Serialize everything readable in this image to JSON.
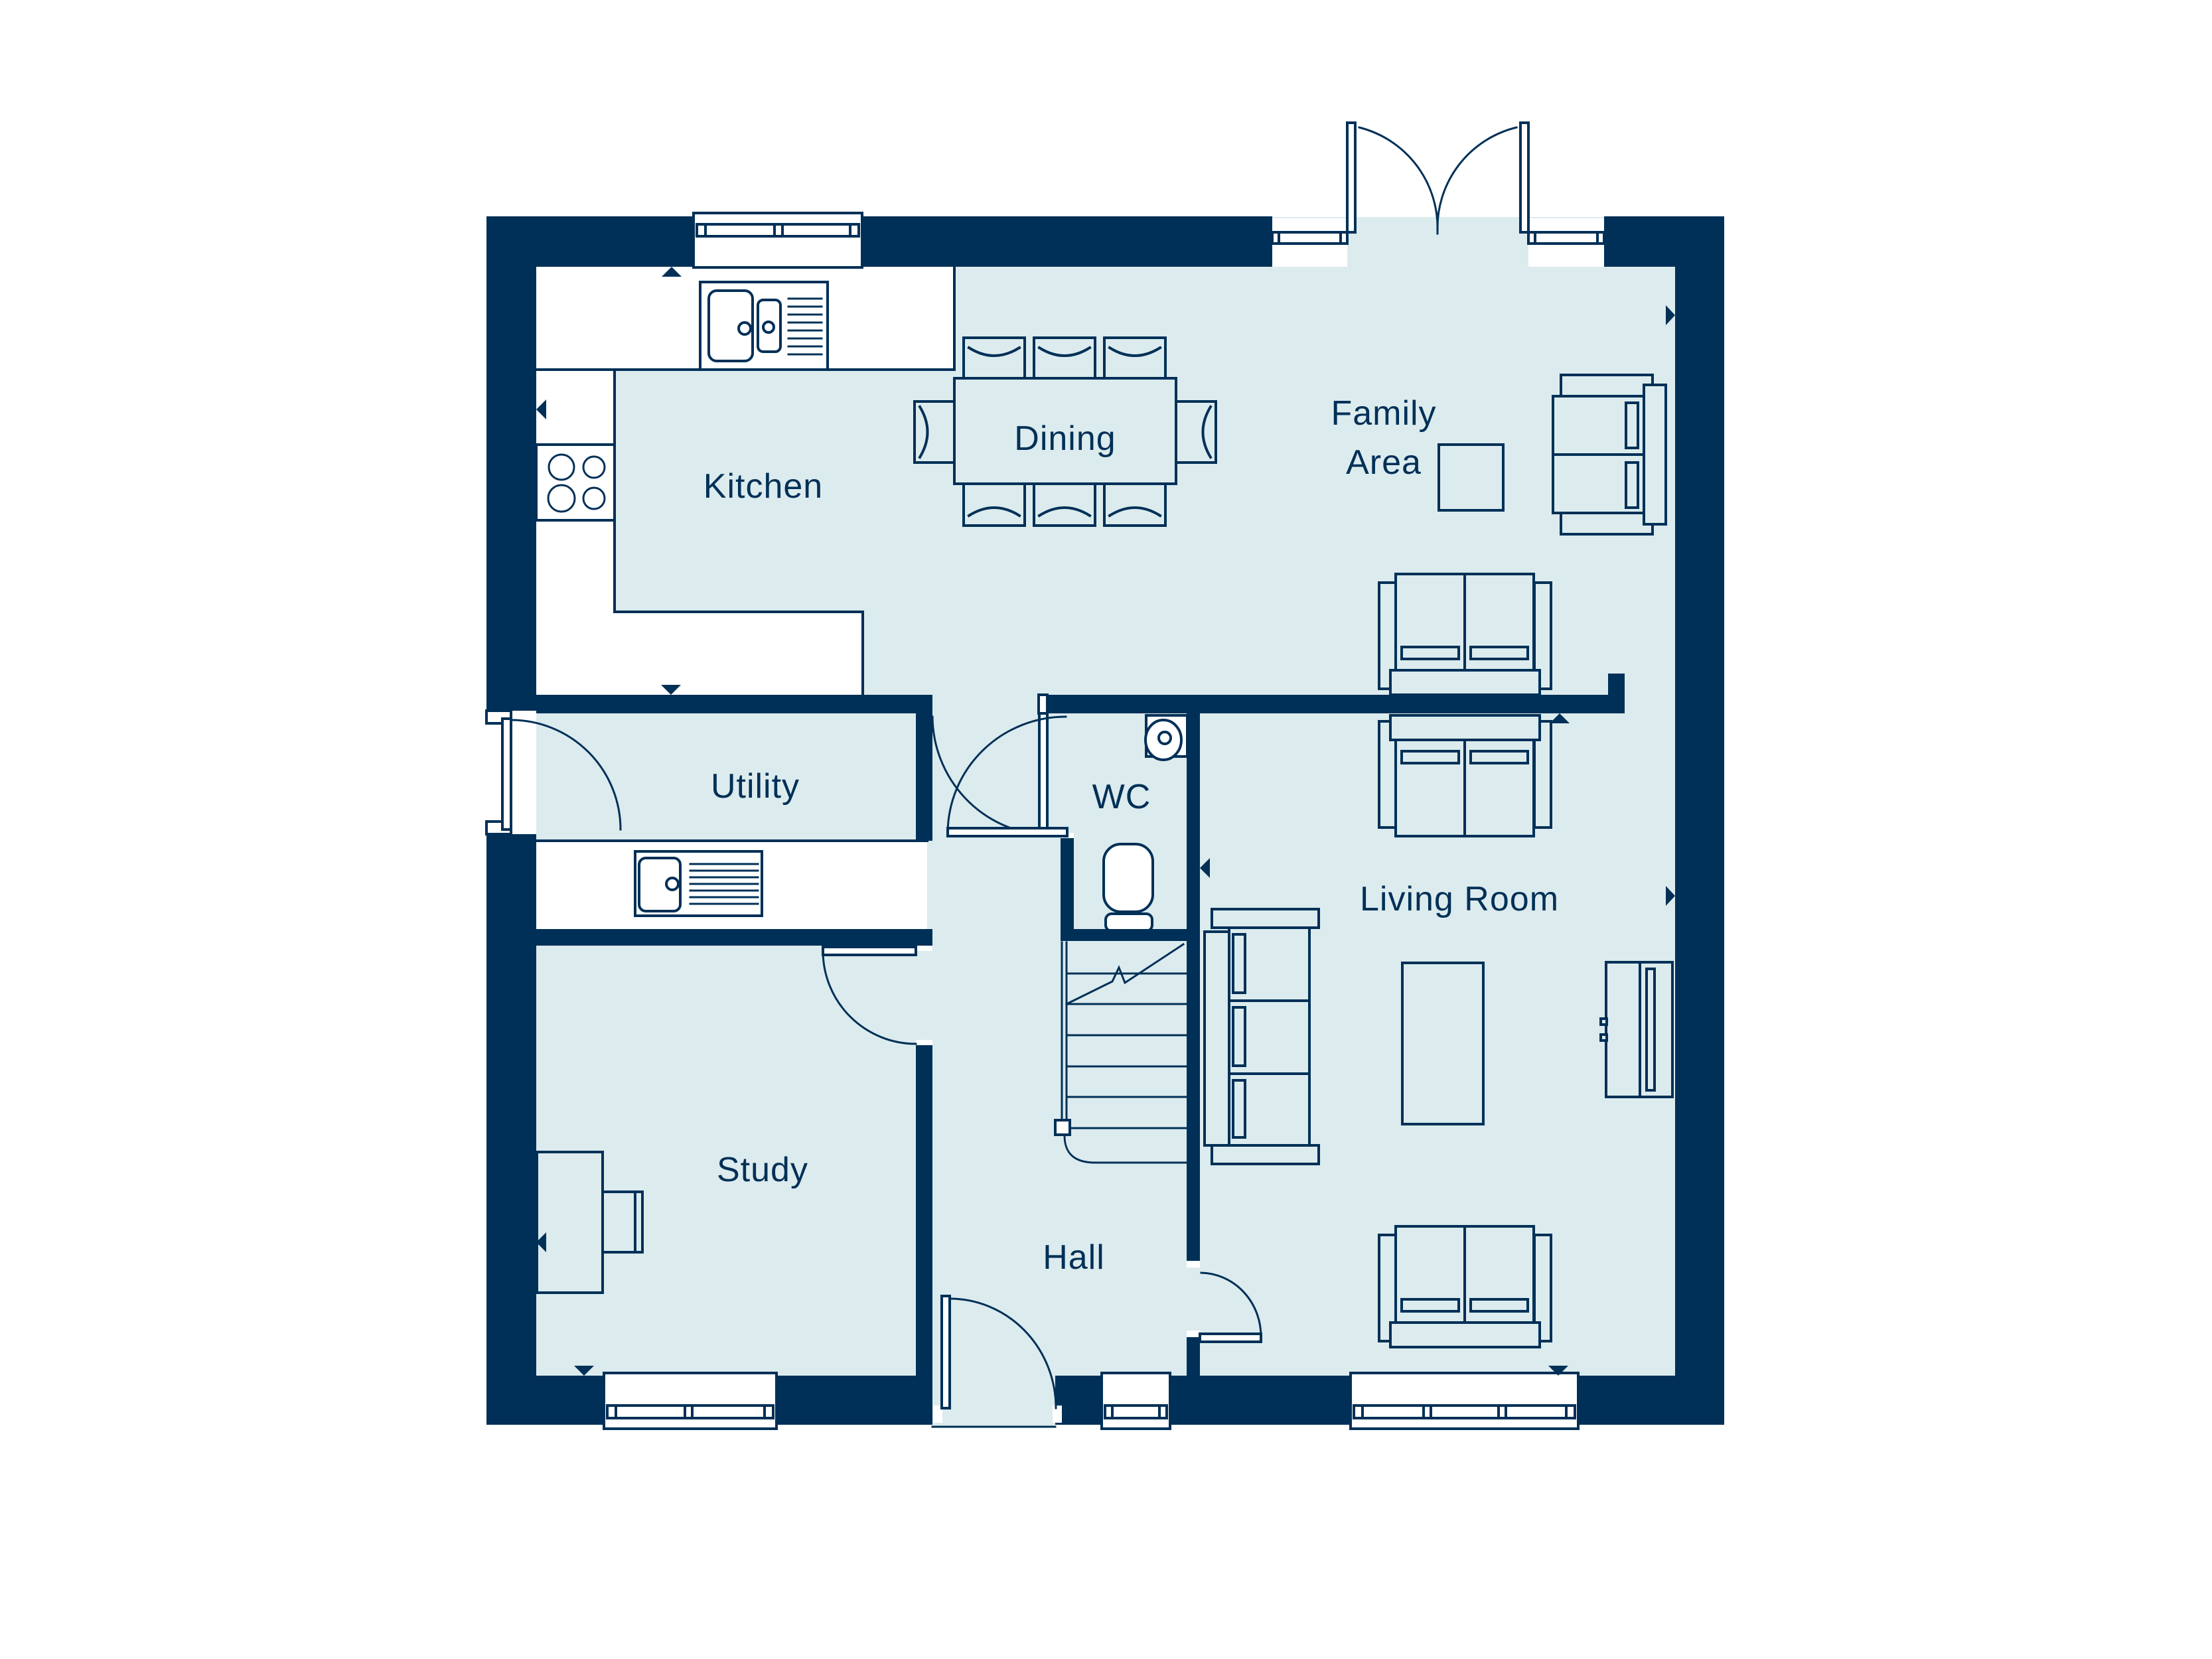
{
  "colors": {
    "wall": "#003057",
    "floor": "#dcebee",
    "line": "#003057",
    "label": "#003057",
    "background": "#ffffff"
  },
  "rooms": {
    "kitchen": "Kitchen",
    "dining": "Dining",
    "family_area_line1": "Family",
    "family_area_line2": "Area",
    "utility": "Utility",
    "wc": "WC",
    "living_room": "Living Room",
    "study": "Study",
    "hall": "Hall"
  }
}
